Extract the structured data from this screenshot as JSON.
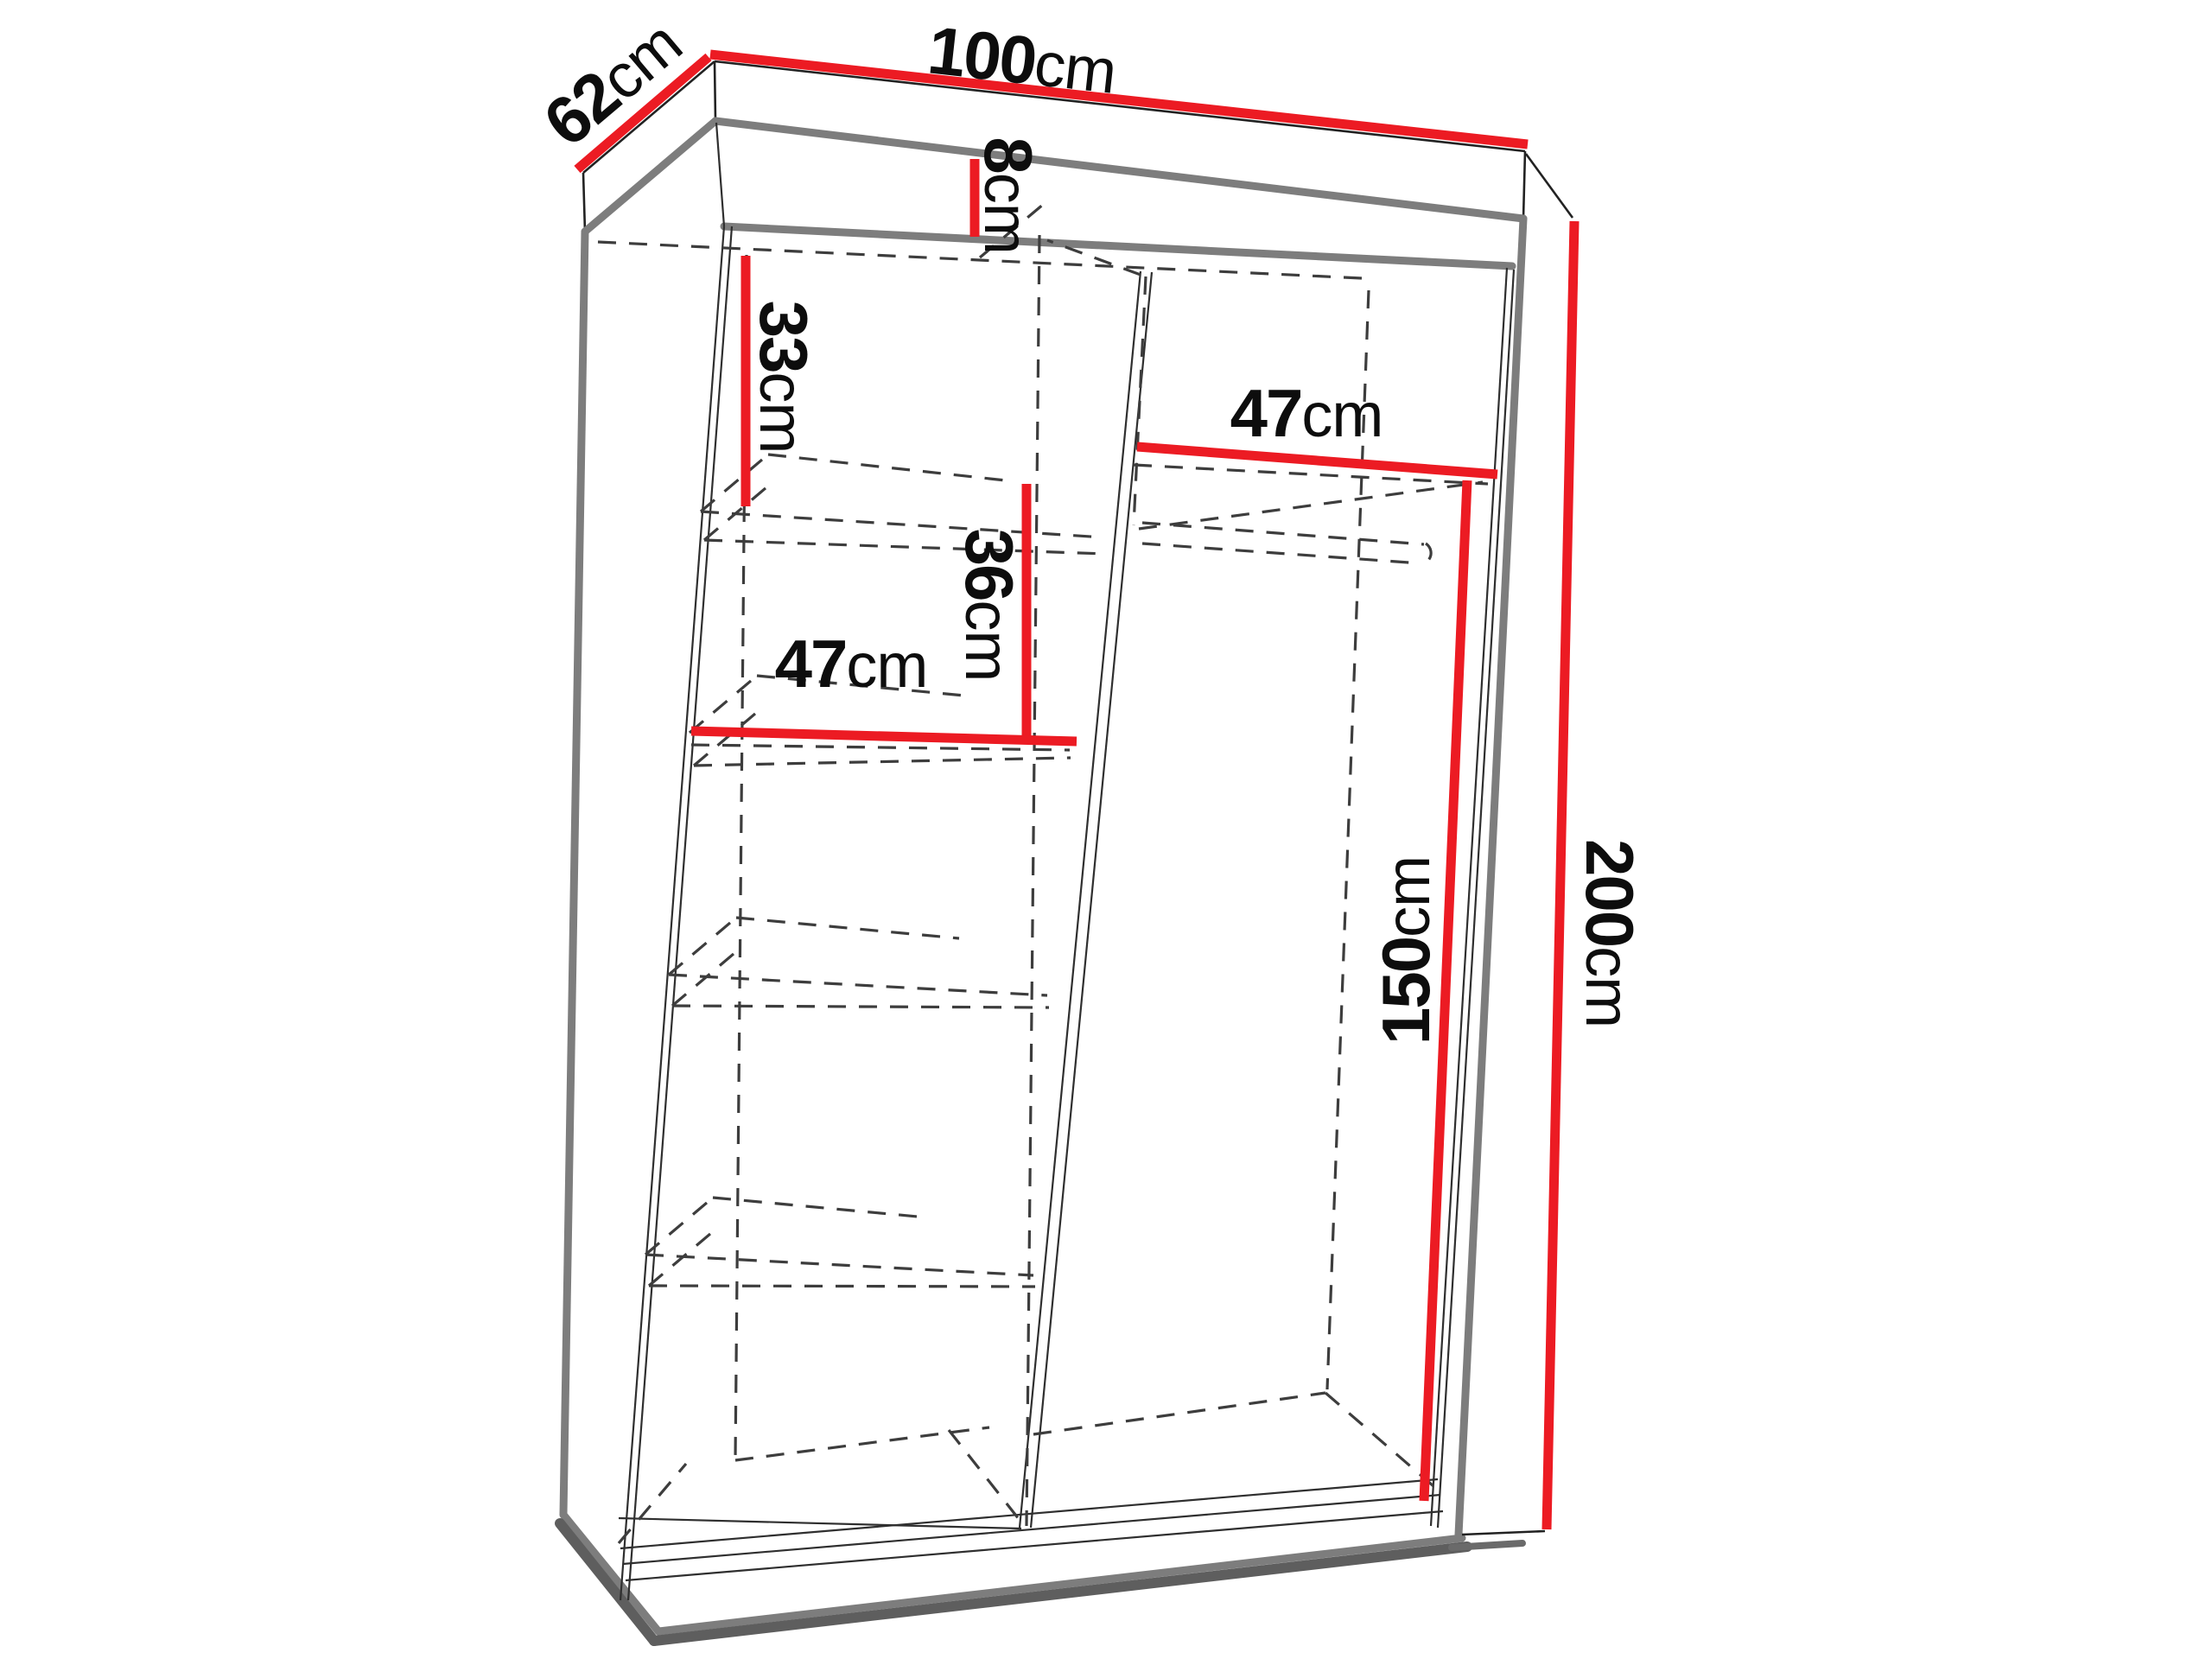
{
  "title": "Wardrobe dimension diagram",
  "diagram_type": "furniture-technical-drawing",
  "colors": {
    "dimension_line": "#ec1b23",
    "edge_gray": "#7d7d7d",
    "hidden_line": "#3d3d3d",
    "text": "#0d0d0d",
    "background": "#ffffff"
  },
  "dims": {
    "width_total": {
      "num": "100",
      "unit": "cm"
    },
    "depth_total": {
      "num": "62",
      "unit": "cm"
    },
    "top_rail_height": {
      "num": "8",
      "unit": "cm"
    },
    "top_shelf_gap": {
      "num": "33",
      "unit": "cm"
    },
    "shelf_gap_middle": {
      "num": "36",
      "unit": "cm"
    },
    "shelf_width_left": {
      "num": "47",
      "unit": "cm"
    },
    "shelf_width_right": {
      "num": "47",
      "unit": "cm"
    },
    "hanging_height": {
      "num": "150",
      "unit": "cm"
    },
    "height_total": {
      "num": "200",
      "unit": "cm"
    }
  }
}
